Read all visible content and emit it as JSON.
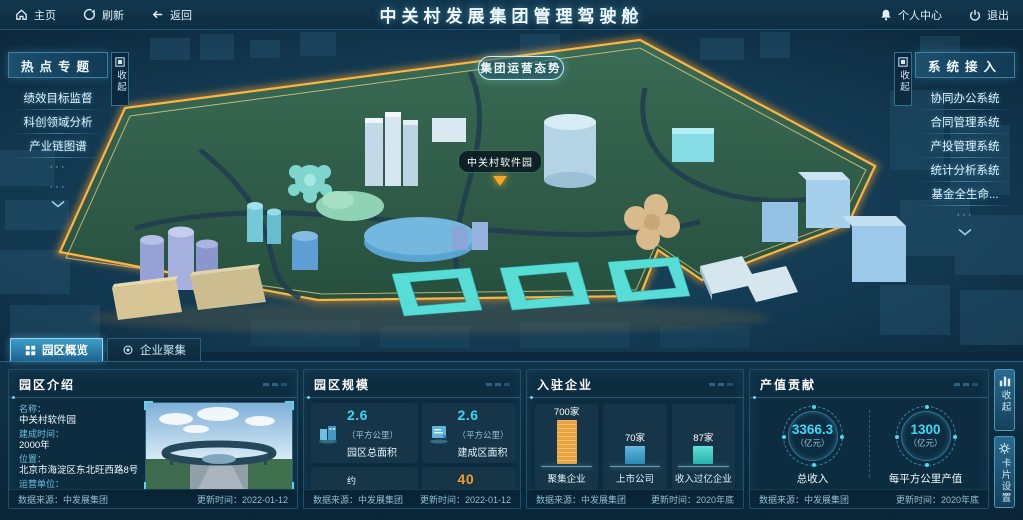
{
  "colors": {
    "accent_cyan": "#3fd4f0",
    "accent_orange": "#f5992e",
    "park_border_glow": "#f7a832",
    "panel_background": "#0d2d40",
    "topbar_background": "#11374d"
  },
  "topbar": {
    "home_label": "主页",
    "refresh_label": "刷新",
    "back_label": "返回",
    "title": "中关村发展集团管理驾驶舱",
    "personal_label": "个人中心",
    "exit_label": "退出"
  },
  "scene": {
    "situation_button": "集团运营态势",
    "map_label": "中关村软件园"
  },
  "left_panel": {
    "title": "热点专题",
    "collapse_label": "收起",
    "items": [
      "绩效目标监督",
      "科创领域分析",
      "产业链图谱"
    ],
    "more": [
      "···",
      "···"
    ]
  },
  "right_panel": {
    "title": "系统接入",
    "collapse_label": "收起",
    "items": [
      "协同办公系统",
      "合同管理系统",
      "产投管理系统",
      "统计分析系统",
      "基金全生命..."
    ],
    "more": [
      "···"
    ]
  },
  "tabs": [
    {
      "label": "园区概览",
      "active": true
    },
    {
      "label": "企业聚集",
      "active": false
    }
  ],
  "panels": {
    "intro": {
      "title": "园区介绍",
      "fields": [
        {
          "label": "名称：",
          "value": "中关村软件园"
        },
        {
          "label": "建成时间：",
          "value": "2000年"
        },
        {
          "label": "位置：",
          "value": "北京市海淀区东北旺西路8号"
        },
        {
          "label": "运营单位：",
          "value": "北京中关村软件园发展有限公司"
        }
      ],
      "source_label": "数据来源：中发展集团",
      "update_label": "更新时间：2022-01-12"
    },
    "scale": {
      "title": "园区规模",
      "stats": [
        {
          "prefix": "",
          "value": "2.6",
          "unit": "（平方公里）",
          "name": "园区总面积",
          "color": "#3fd4f0"
        },
        {
          "prefix": "",
          "value": "2.6",
          "unit": "（平方公里）",
          "name": "建成区面积",
          "color": "#3fd4f0"
        },
        {
          "prefix": "约",
          "value": "310",
          "unit": "(万平方米)",
          "name": "载体面积",
          "color": "#f5992e"
        },
        {
          "prefix": "",
          "value": "40",
          "unit": "（万平方米）",
          "name": "自持面积",
          "color": "#f5992e"
        }
      ],
      "source_label": "数据来源：中发展集团",
      "update_label": "更新时间：2022-01-12"
    },
    "enterprises": {
      "title": "入驻企业",
      "chart_data": {
        "type": "bar",
        "categories": [
          "聚集企业",
          "上市公司",
          "收入过亿企业"
        ],
        "values": [
          700,
          70,
          87
        ],
        "value_labels": [
          "700家",
          "70家",
          "87家"
        ],
        "bar_colors": [
          "#e8a33d",
          "#2e9fd4",
          "#2bd4c8"
        ]
      },
      "source_label": "数据来源：中发展集团",
      "update_label": "更新时间：2020年底"
    },
    "output": {
      "title": "产值贡献",
      "gauges": [
        {
          "value": "3366.3",
          "unit": "（亿元）",
          "name": "总收入"
        },
        {
          "value": "1300",
          "unit": "（亿元）",
          "name": "每平方公里产值"
        }
      ],
      "source_label": "数据来源：中发展集团",
      "update_label": "更新时间：2020年底"
    }
  },
  "side_buttons": {
    "collapse_label": "收起",
    "settings_label": "卡片设置"
  }
}
